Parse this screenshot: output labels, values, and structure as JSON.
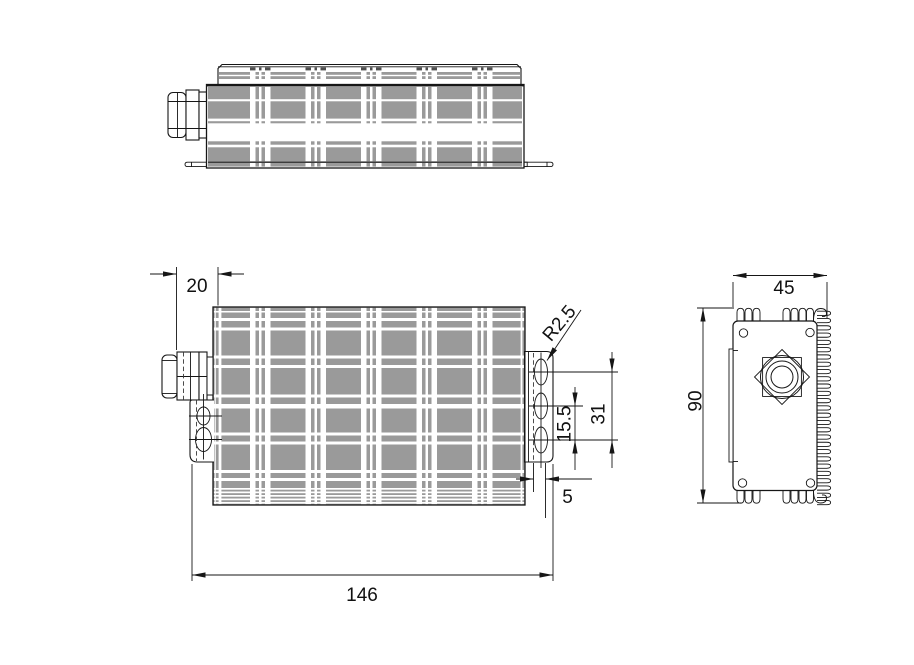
{
  "drawing": {
    "type": "engineering-orthographic-views",
    "dimensions": {
      "d20": "20",
      "d146": "146",
      "d45": "45",
      "d90": "90",
      "d31": "31",
      "d15_5": "15.5",
      "d5": "5",
      "r2_5": "R2.5"
    },
    "colors": {
      "body_gray": "#9a9a9a",
      "line": "#161616",
      "text": "#111111",
      "dash_dark": "#4f4f4f",
      "background": "#ffffff"
    }
  }
}
